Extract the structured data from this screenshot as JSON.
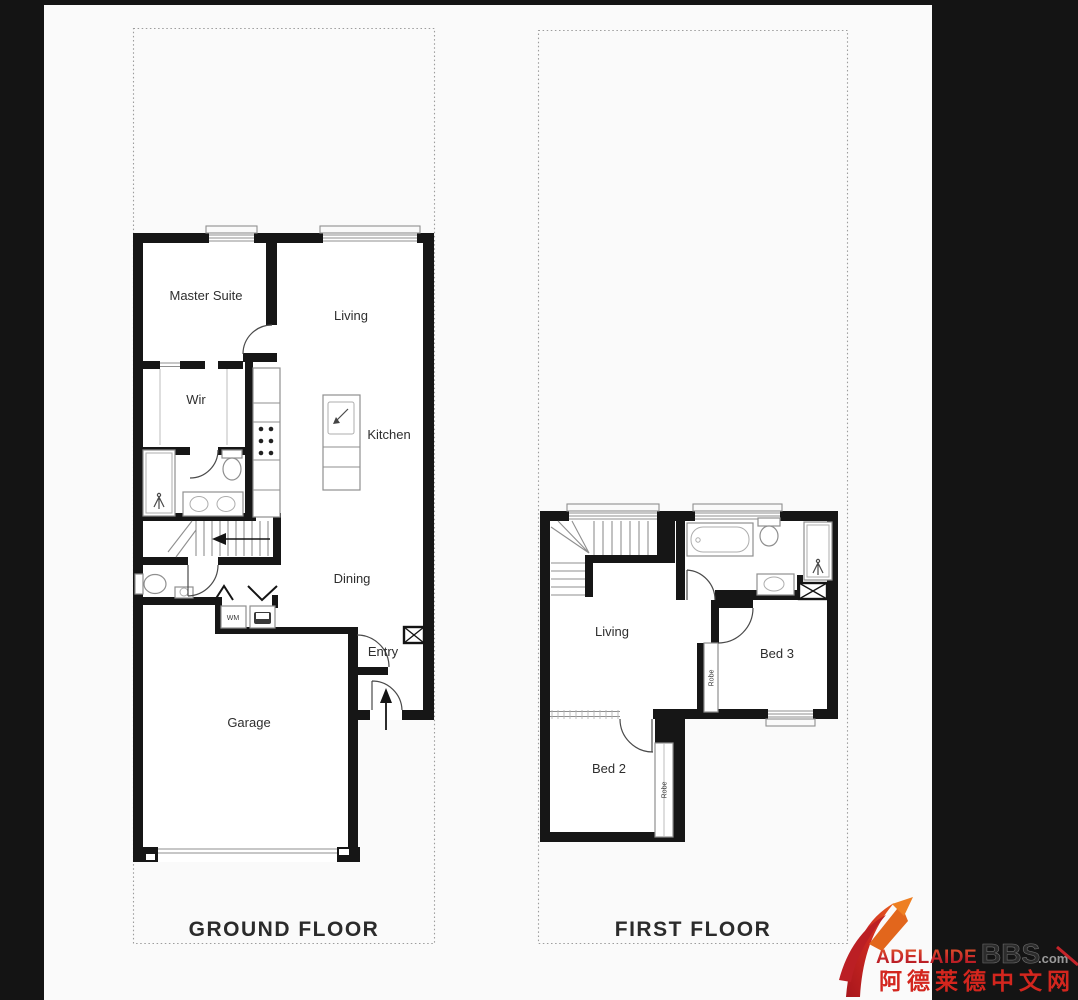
{
  "ground_floor": {
    "title": "GROUND FLOOR",
    "rooms": {
      "master": "Master Suite",
      "living": "Living",
      "wir": "Wir",
      "kitchen": "Kitchen",
      "dining": "Dining",
      "entry": "Entry",
      "garage": "Garage",
      "wm": "WM"
    }
  },
  "first_floor": {
    "title": "FIRST FLOOR",
    "rooms": {
      "living": "Living",
      "bed3": "Bed 3",
      "bed2": "Bed 2",
      "robe_bed3": "Robe",
      "robe_bed2": "Robe"
    }
  },
  "watermark": {
    "brand": "Adelaide",
    "bbs": "BBS",
    "tld": ".com",
    "chinese": "阿德莱德中文网"
  },
  "colors": {
    "wall": "#161616",
    "canvas": "#fafafa",
    "brand_red": "#c6242a",
    "chinese_red": "#d3261e",
    "bbs_dark": "#2c2c2c",
    "com_gray": "#9a9a9a"
  }
}
